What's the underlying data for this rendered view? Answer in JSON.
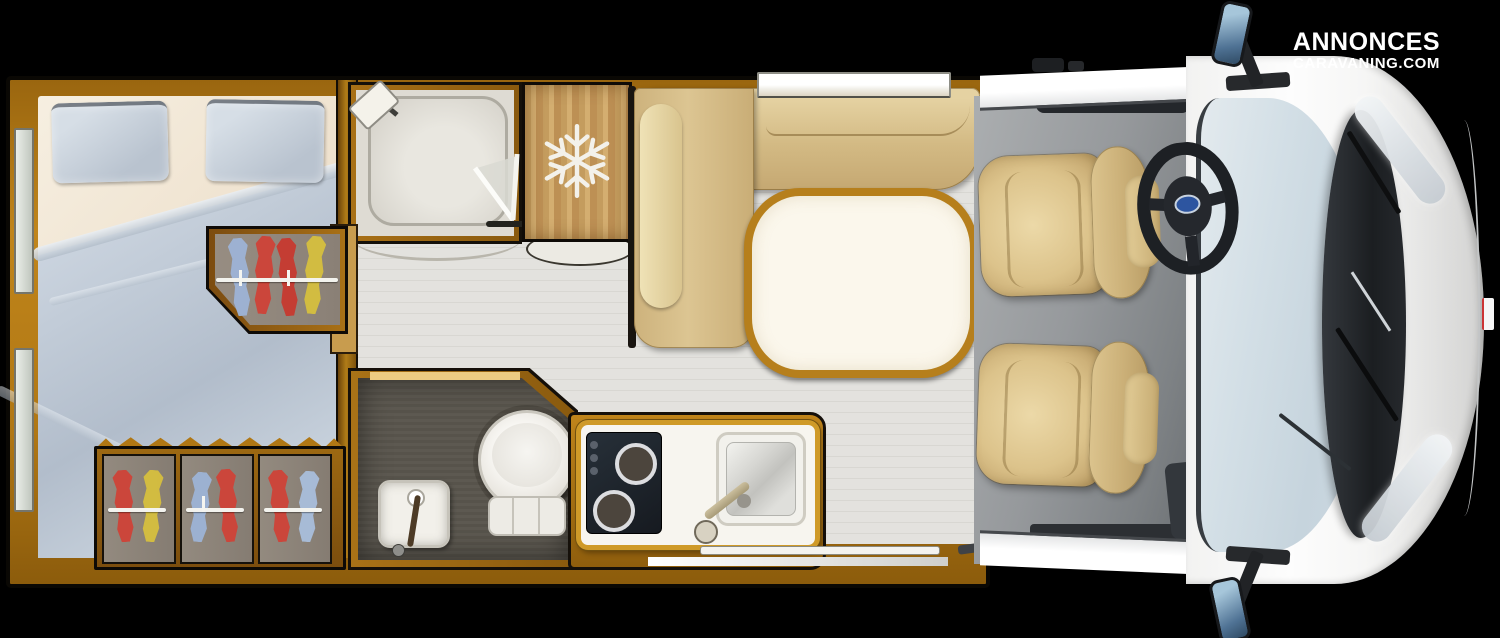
{
  "brand": {
    "line1": "ANNONCES",
    "line2": "CARAVANING.COM"
  },
  "icons": {
    "snowflake": "snowflake-icon (freezer/fridge)",
    "shower_head": "shower-head-icon",
    "steering_wheel": "steering-wheel-icon",
    "hanger": "clothes-hanger-icon"
  },
  "palette": {
    "background": "#000000",
    "wood_wall": "#b07714",
    "floor_plank": "#dcdbd6",
    "bed_duvet": "#c2ccd8",
    "bed_sheet": "#f3ead9",
    "sofa_tan": "#d3ba84",
    "table_rim": "#b67f1c",
    "bathroom_floor": "#57534b",
    "cab_floor": "#8f9396",
    "windshield_blue": "#ccd8e0",
    "vehicle_white": "#f6f6f5",
    "ford_badge_blue": "#2d55a0"
  },
  "wardrobes": {
    "rear": {
      "garments": [
        "#9db3d6",
        "#cf4238",
        "#c7392f",
        "#d6bf3e"
      ]
    },
    "bottom": [
      {
        "garments": [
          "#cf4238",
          "#d6bf3e"
        ]
      },
      {
        "garments": [
          "#9db3d6",
          "#cf4238"
        ]
      },
      {
        "garments": [
          "#cf4238",
          "#a9bedb"
        ]
      }
    ]
  }
}
